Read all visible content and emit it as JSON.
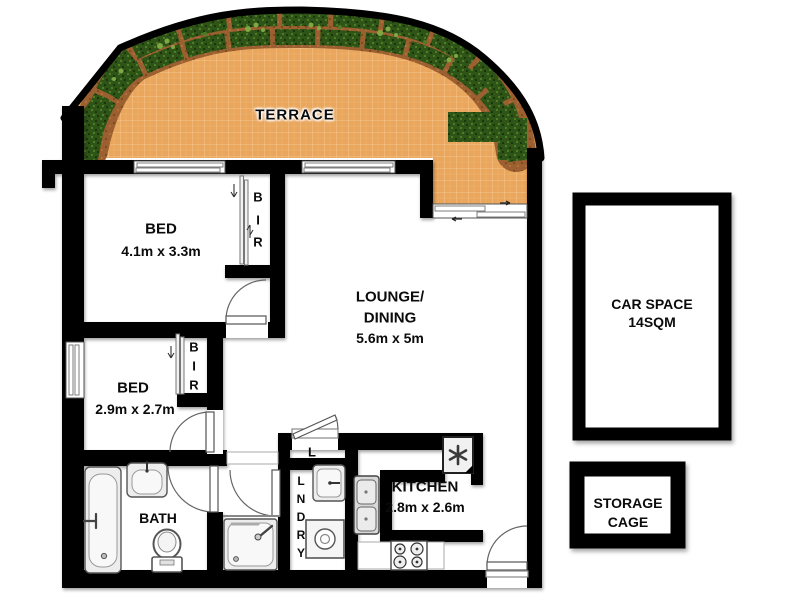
{
  "title": "Apartment floor plan",
  "rooms": {
    "terrace": {
      "label": "TERRACE"
    },
    "bed1": {
      "label": "BED",
      "dims": "4.1m x 3.3m"
    },
    "bir1": {
      "letters": [
        "B",
        "I",
        "R"
      ]
    },
    "lounge": {
      "line1": "LOUNGE/",
      "line2": "DINING",
      "dims": "5.6m x 5m"
    },
    "bed2": {
      "label": "BED",
      "dims": "2.9m x 2.7m"
    },
    "bir2": {
      "letters": [
        "B",
        "I",
        "R"
      ]
    },
    "bath": {
      "label": "BATH"
    },
    "linen": {
      "label": "L"
    },
    "laundry": {
      "letters": [
        "L",
        "N",
        "D",
        "R",
        "Y"
      ]
    },
    "kitchen": {
      "label": "KITCHEN",
      "dims": "2.8m x 2.6m"
    }
  },
  "outbuildings": {
    "carspace": {
      "line1": "CAR SPACE",
      "line2": "14SQM"
    },
    "storage": {
      "line1": "STORAGE",
      "line2": "CAGE"
    }
  },
  "colors": {
    "wall": "#000000",
    "terrace_tile": "#EAA65C",
    "tile_line": "#F4C78F",
    "hedge": "#2F5418",
    "hedge_light": "#4E7D26",
    "hedge_dark": "#1C350B",
    "planter": "#9C5F30",
    "planter_dark": "#7E4A22",
    "vine": "#7FA845",
    "fixture_fill": "#EDEDED",
    "fixture_stroke": "#555555"
  }
}
